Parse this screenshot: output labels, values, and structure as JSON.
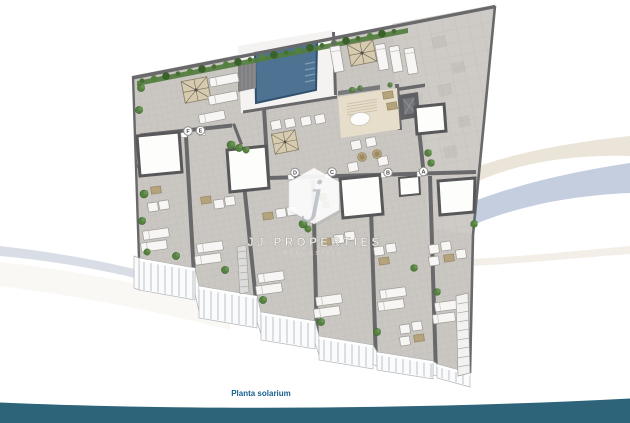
{
  "page": {
    "background": "#ffffff"
  },
  "plan": {
    "caption": "Planta solarium",
    "unit_labels": [
      "F",
      "E",
      "D",
      "C",
      "B",
      "A"
    ]
  },
  "watermark": {
    "initial": "j",
    "name": "JJ PROPERTIES",
    "tagline": "REAL ESTATE"
  },
  "palette": {
    "page-bg": "#ffffff",
    "pool": "#4e7392",
    "pool-edge": "#31506e",
    "deck": "#f4f3f1",
    "tile": "#cac7c2",
    "tile-big": "#cecbc6",
    "grid": "#bcb8b3",
    "wall": "#69696b",
    "hedge": "#517c3e",
    "plant": "#55813f",
    "parasol": "#d6cbaf",
    "furniture": "#f7f6f4",
    "furniture-edge": "#9d9b97",
    "table-tan": "#b5a37c",
    "railing": "#fafbfc",
    "railing-edge": "#b2b5b8",
    "bar-floor": "#e7ddcb",
    "elevator": "#606165",
    "band": "#2e6479",
    "swoosh-blue": "#c4cedf",
    "swoosh-beige": "#ebe5d9",
    "swoosh-gray": "#ccd3de",
    "caption": "#19618f"
  }
}
